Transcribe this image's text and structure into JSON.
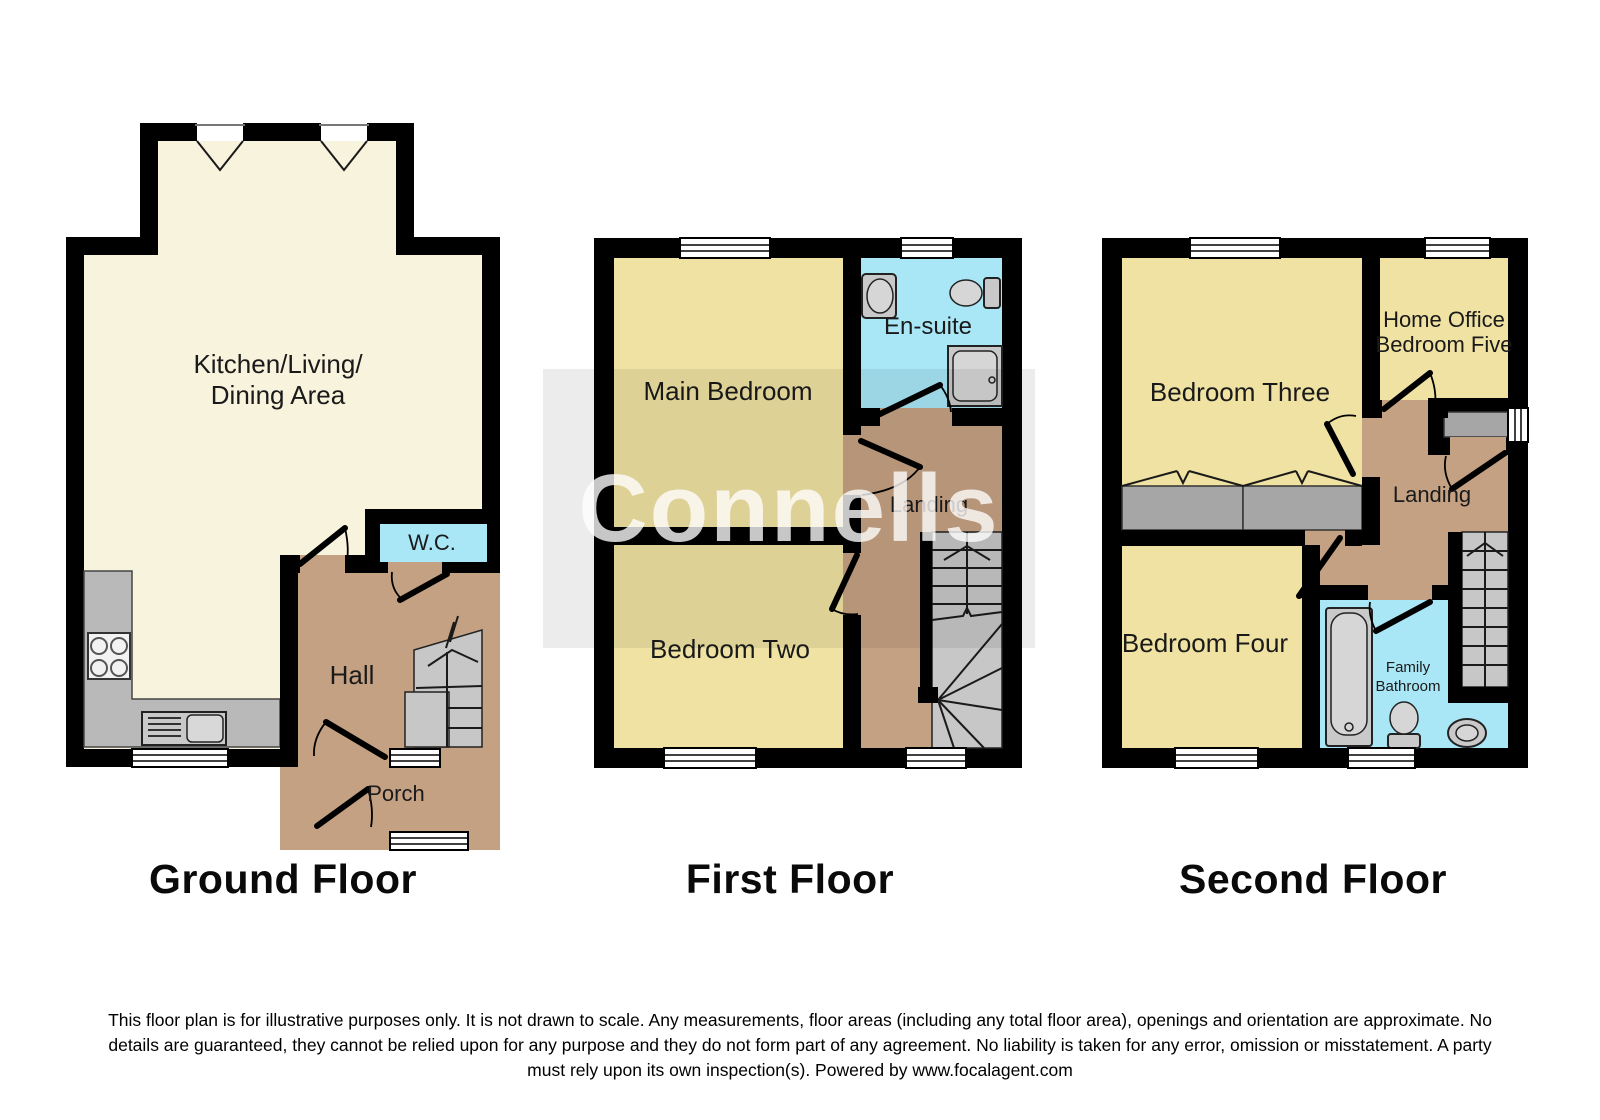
{
  "watermark": {
    "text": "Connells"
  },
  "colors": {
    "wall_black": "#000000",
    "room_cream": "#f8f3dd",
    "room_yellow": "#efe2a2",
    "hall_brown": "#c5a183",
    "wet_blue": "#a9e7f7",
    "fixture_gray": "#b9b9b9",
    "stair_gray": "#c7c7c7",
    "wardrobe_gray": "#a6a6a6"
  },
  "floors": [
    {
      "title": "Ground Floor",
      "rooms": {
        "kitchen_living_line1": "Kitchen/Living/",
        "kitchen_living_line2": "Dining Area",
        "wc": "W.C.",
        "hall": "Hall",
        "porch": "Porch"
      }
    },
    {
      "title": "First Floor",
      "rooms": {
        "main_bedroom": "Main Bedroom",
        "ensuite": "En-suite",
        "landing": "Landing",
        "bedroom_two": "Bedroom Two"
      }
    },
    {
      "title": "Second Floor",
      "rooms": {
        "bedroom_three": "Bedroom Three",
        "home_office_line1": "Home Office",
        "home_office_line2": "Bedroom Five",
        "landing": "Landing",
        "bedroom_four": "Bedroom Four",
        "family_bathroom_line1": "Family",
        "family_bathroom_line2": "Bathroom"
      }
    }
  ],
  "disclaimer": {
    "line1": "This floor plan is for illustrative purposes only. It is not drawn to scale. Any measurements, floor areas (including any total floor area), openings and orientation are approximate. No",
    "line2": "details are guaranteed, they cannot be relied upon for any purpose and they do not form part of any agreement. No liability is taken for any error, omission or misstatement. A party",
    "line3": "must rely upon its own inspection(s). Powered by www.focalagent.com"
  }
}
